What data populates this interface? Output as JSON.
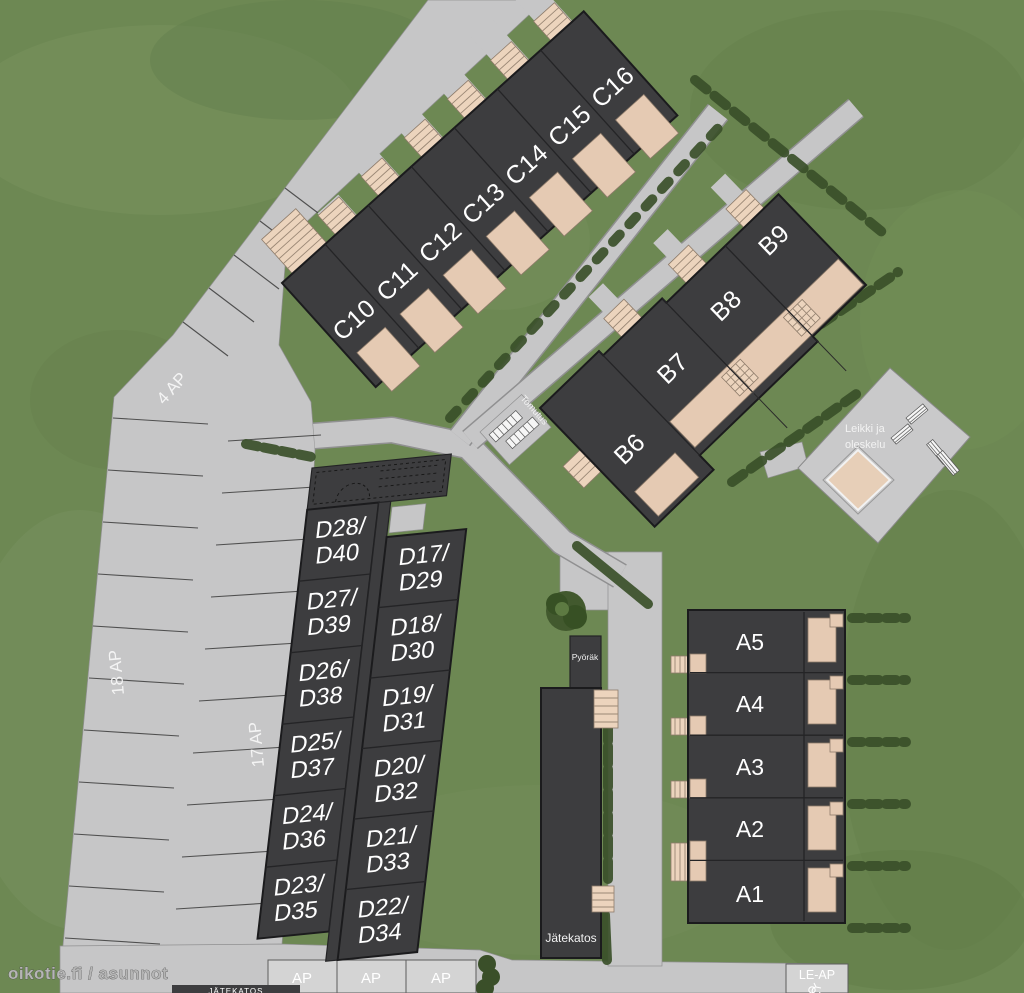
{
  "site_plan": {
    "units": {
      "c_row": [
        "C10",
        "C11",
        "C12",
        "C13",
        "C14",
        "C15",
        "C16"
      ],
      "b_row": [
        "B6",
        "B7",
        "B8",
        "B9"
      ],
      "a_row": [
        "A5",
        "A4",
        "A3",
        "A2",
        "A1"
      ],
      "d_left": [
        [
          "D28/",
          "D40"
        ],
        [
          "D27/",
          "D39"
        ],
        [
          "D26/",
          "D38"
        ],
        [
          "D25/",
          "D37"
        ],
        [
          "D24/",
          "D36"
        ],
        [
          "D23/",
          "D35"
        ]
      ],
      "d_right": [
        [
          "D17/",
          "D29"
        ],
        [
          "D18/",
          "D30"
        ],
        [
          "D19/",
          "D31"
        ],
        [
          "D20/",
          "D32"
        ],
        [
          "D21/",
          "D33"
        ],
        [
          "D22/",
          "D34"
        ]
      ]
    },
    "parking": {
      "four_ap": "4 AP",
      "eighteen_ap": "18 AP",
      "seventeen_ap": "17 AP",
      "ap_stalls": [
        "AP",
        "AP",
        "AP"
      ],
      "le_ap": "LE-AP"
    },
    "facilities": {
      "bike_shelter": "Pyöräk",
      "waste_shelter": "Jätekatos",
      "waste_shelter_clipped": "JÄTEKATOS",
      "carpet_beating": "Tomutus",
      "play_area_line1": "Leikki ja",
      "play_area_line2": "oleskelu"
    },
    "watermark": "oikotie.fi / asunnot",
    "colors": {
      "grass": "#6d8853",
      "road": "#c6c6c7",
      "stall": "#d4d4d4",
      "building": "#3d3d3f",
      "patio": "#e5cab3",
      "hedge": "#3a4f29",
      "plaza": "#c9c9ca",
      "sandbox": "#e7cfb8",
      "label": "#ffffff",
      "watermark": "#b5b5b5"
    }
  }
}
